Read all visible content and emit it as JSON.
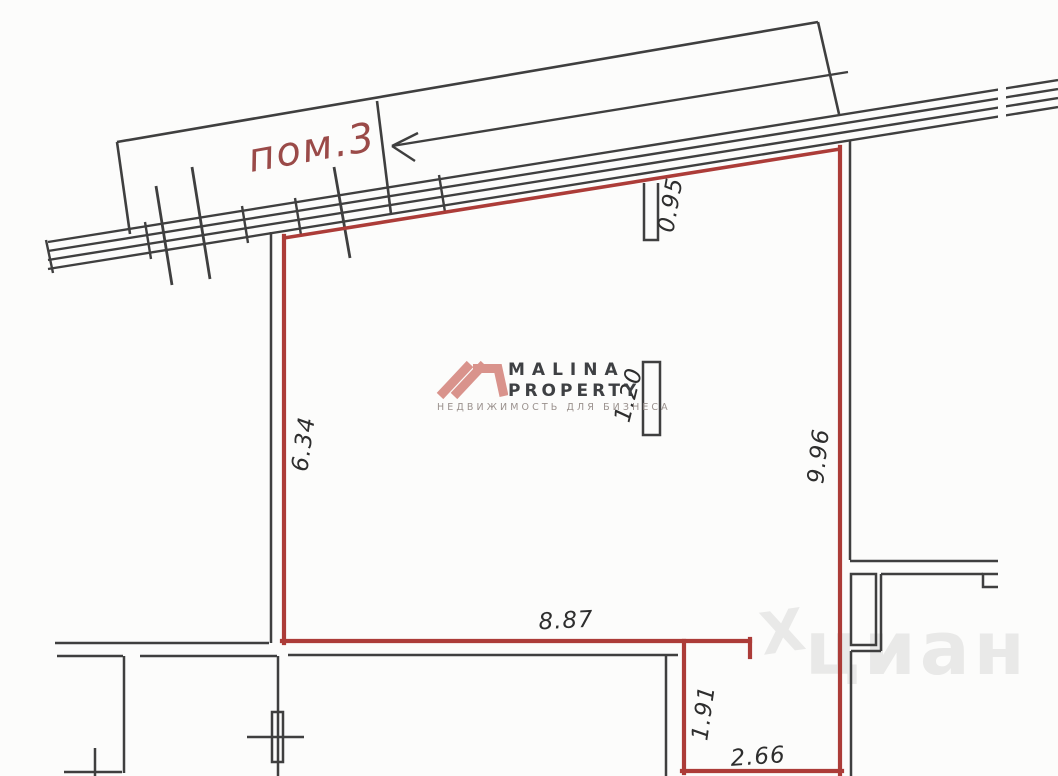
{
  "drawing": {
    "room_label": "пом.3",
    "dimensions": {
      "partition_top": "0.95",
      "partition_mid": "1.20",
      "wall_left": "6.34",
      "wall_right": "9.96",
      "wall_bottom": "8.87",
      "alcove_height": "1.91",
      "alcove_width": "2.66"
    },
    "colors": {
      "room_outline_red": "#ac3c38",
      "wall_line_black": "#3f3f3f",
      "room_label_red": "#9a4a48"
    }
  },
  "watermarks": {
    "malina": {
      "name": "MALINA",
      "type": "PROPERTY",
      "tagline": "НЕДВИЖИМОСТЬ ДЛЯ БИЗНЕСА",
      "logo_color": "#d9938c"
    },
    "cian": {
      "glyph": "Х",
      "text": "циан"
    }
  }
}
